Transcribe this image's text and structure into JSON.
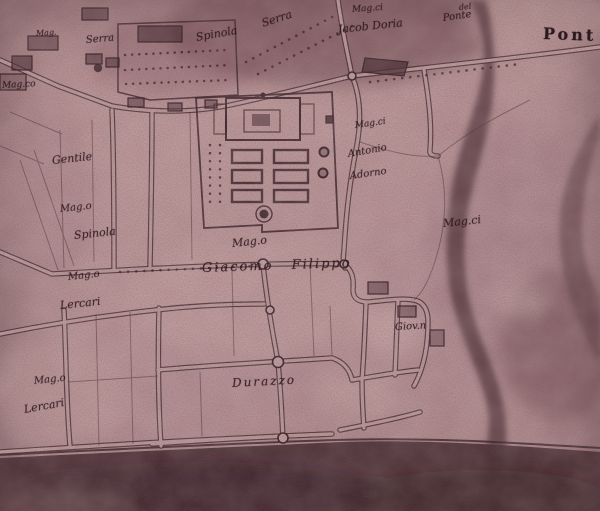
{
  "meta": {
    "description_label": "Photographic reproduction of a hand-drawn historic villa map"
  },
  "palette": {
    "paper_light": "#c6a1a0",
    "paper_mid": "#b28b8d",
    "wash_dark": "#6a454c",
    "ink": "#2a141a",
    "river": "#4e3036",
    "bottom_band": "#3c2428"
  },
  "labels": [
    {
      "id": "mag-topleft-tiny",
      "text": "Mag."
    },
    {
      "id": "serra-topleft",
      "text": "Serra"
    },
    {
      "id": "spinola-top",
      "text": "Spinola"
    },
    {
      "id": "serra-top",
      "text": "Serra"
    },
    {
      "id": "magci-doria",
      "text": "Mag.ci"
    },
    {
      "id": "jacob-doria",
      "text": "Jacob Doria"
    },
    {
      "id": "del",
      "text": "del"
    },
    {
      "id": "ponte-small",
      "text": "Ponte"
    },
    {
      "id": "pont-large",
      "text": "Pont"
    },
    {
      "id": "magco-left",
      "text": "Mag.co"
    },
    {
      "id": "gentile",
      "text": "Gentile"
    },
    {
      "id": "mago-spinola",
      "text": "Mag.o"
    },
    {
      "id": "spinola-left",
      "text": "Spinola"
    },
    {
      "id": "mago-lercari-1",
      "text": "Mag.o"
    },
    {
      "id": "lercari-1",
      "text": "Lercari"
    },
    {
      "id": "mago-lercari-2",
      "text": "Mag.o"
    },
    {
      "id": "lercari-2",
      "text": "Lercari"
    },
    {
      "id": "magci-adorno",
      "text": "Mag.ci"
    },
    {
      "id": "antonio",
      "text": "Antonio"
    },
    {
      "id": "adorno",
      "text": "Adorno"
    },
    {
      "id": "mago-central",
      "text": "Mag.o"
    },
    {
      "id": "giacomo-filippo",
      "text": "Giacomo Filippo"
    },
    {
      "id": "magci-right",
      "text": "Mag.ci"
    },
    {
      "id": "giovn",
      "text": "Giov.n"
    },
    {
      "id": "durazzo",
      "text": "Durazzo"
    }
  ]
}
